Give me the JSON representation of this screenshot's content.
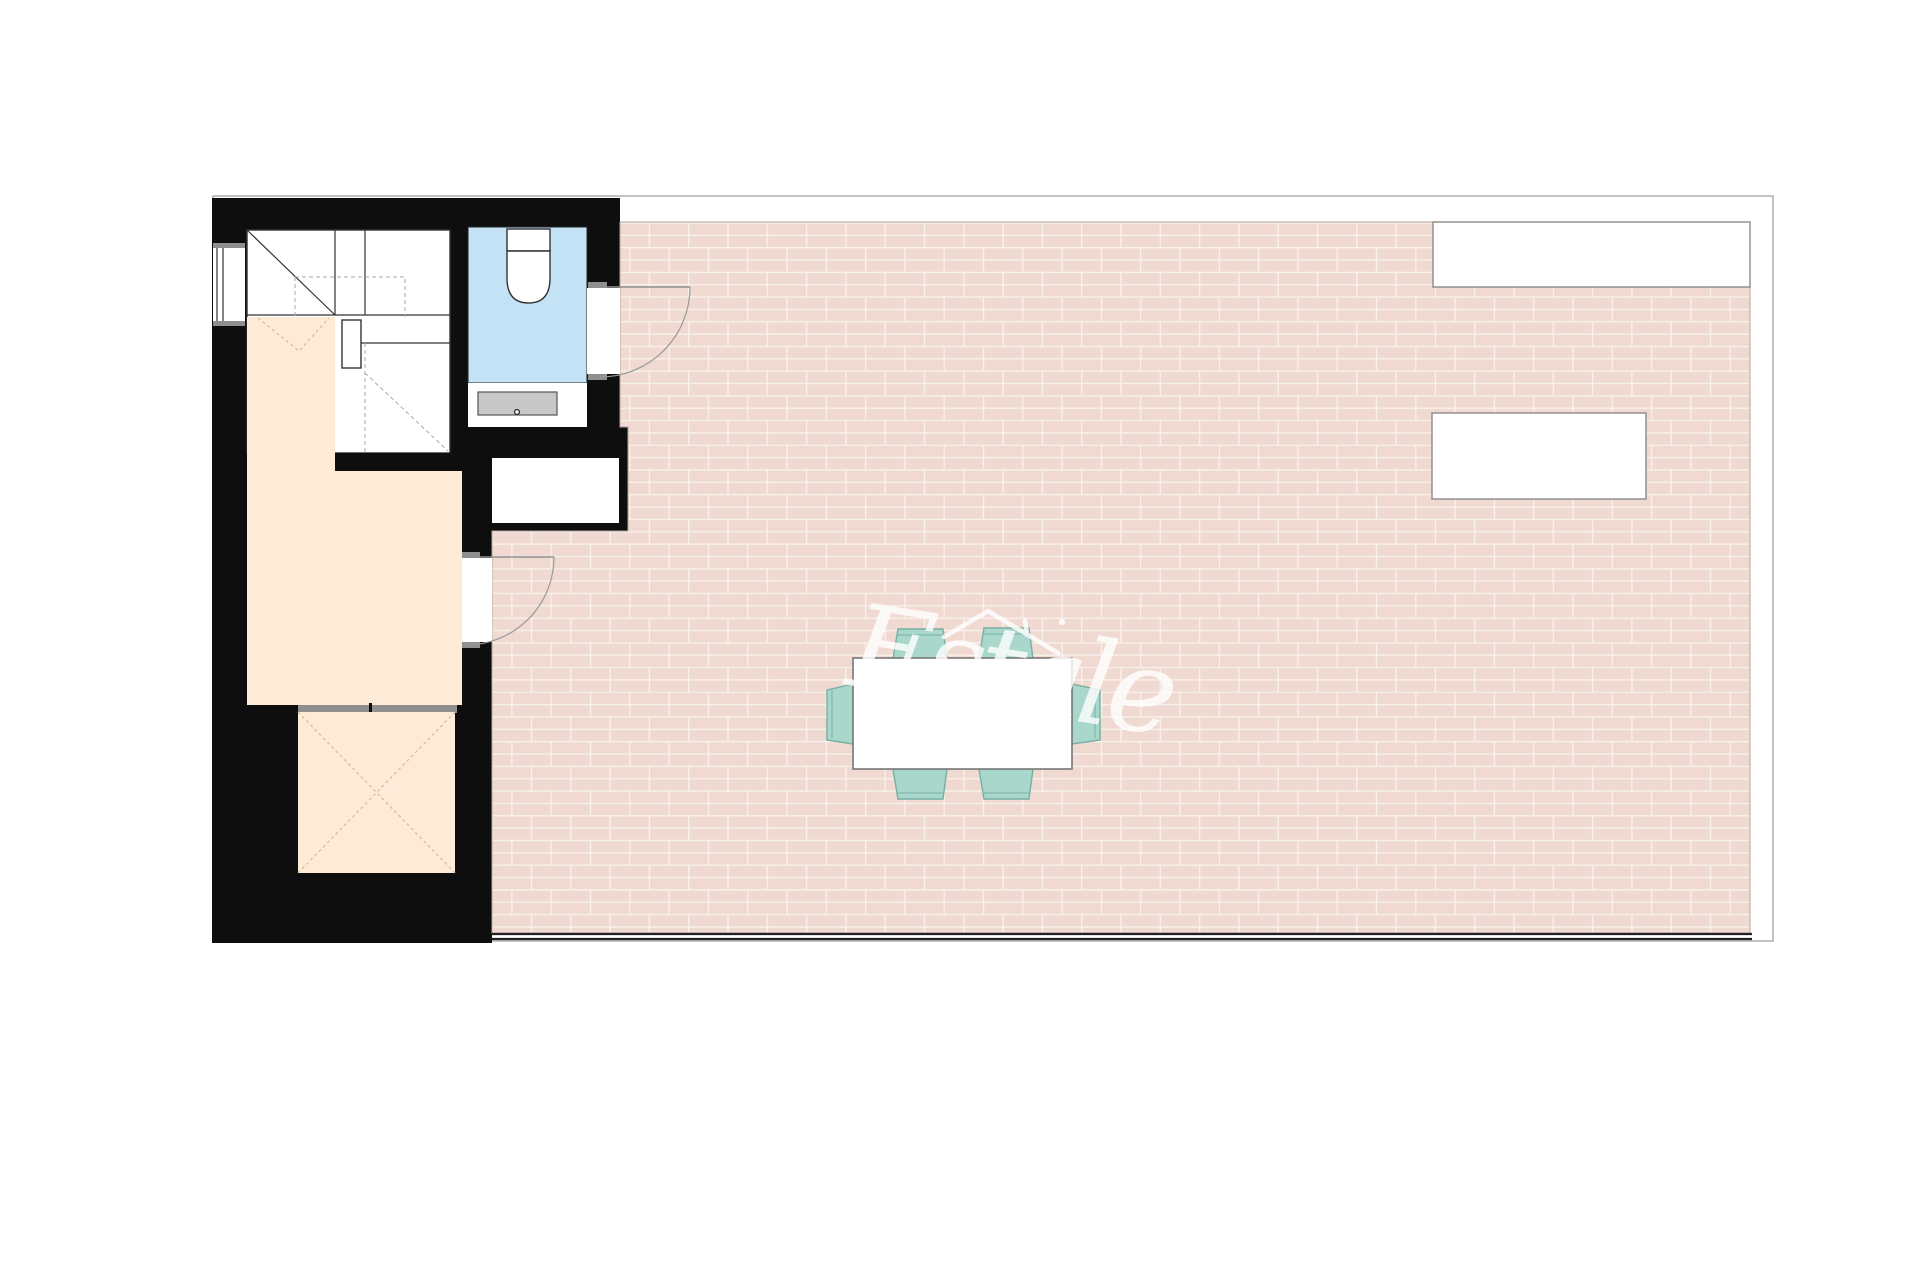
{
  "page": {
    "background": "#ffffff",
    "kind_label": "apartment floor plan with roof terrace"
  },
  "watermark": {
    "text": "Estale",
    "icon": "house-roof-icon"
  },
  "colors": {
    "wall": "#0e0e0e",
    "terrace_tile": "#efd9d1",
    "tile_grout": "#f9f1ec",
    "room_floor": "#fdebd8",
    "bathroom_floor": "#c3e2f5",
    "chair": "#a9d7cb",
    "chair_border": "#76b0a3",
    "fixture_gray": "#c8c8c8",
    "window_band": "#8f8f8f",
    "plan_border": "#999999",
    "edge_line": "#222222",
    "accent_dash": "#d8b999"
  }
}
